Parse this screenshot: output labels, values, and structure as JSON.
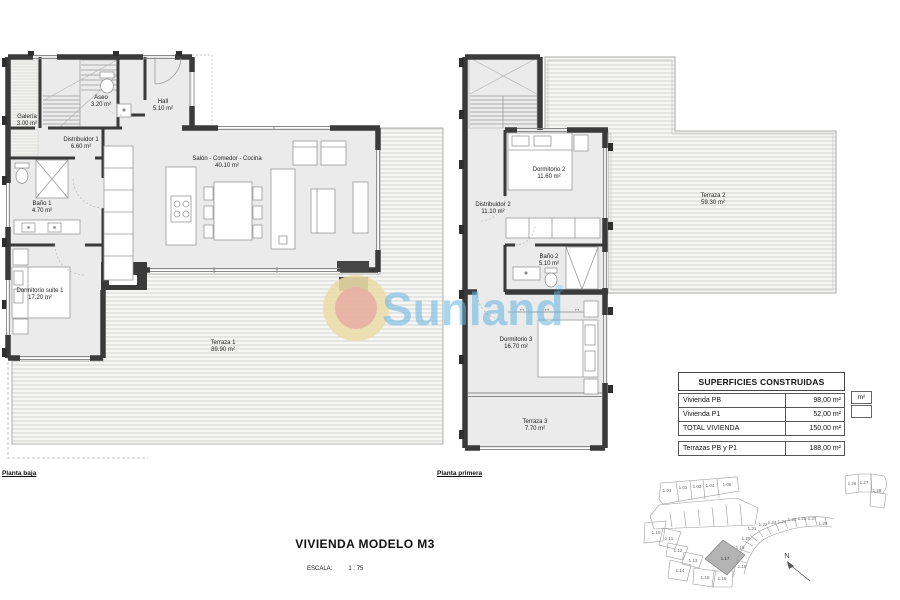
{
  "watermark": {
    "brand": "Sunland",
    "registered_mark": "®"
  },
  "floor_plans": {
    "left": {
      "caption": "Planta baja",
      "rooms": {
        "galeria": {
          "name": "Galería",
          "area": "3.00 m²"
        },
        "aseo": {
          "name": "Aseo",
          "area": "3.20 m²"
        },
        "hall": {
          "name": "Hall",
          "area": "5.10 m²"
        },
        "distribuidor1": {
          "name": "Distribuidor 1",
          "area": "6.60 m²"
        },
        "salon": {
          "name": "Salón - Comedor - Cocina",
          "area": "40.10 m²"
        },
        "bano1": {
          "name": "Baño 1",
          "area": "4.70 m²"
        },
        "dormitorio_suite1": {
          "name": "Dormitorio suite 1",
          "area": "17.20 m²"
        },
        "terraza1": {
          "name": "Terraza 1",
          "area": "89.90 m²"
        }
      }
    },
    "right": {
      "caption": "Planta primera",
      "rooms": {
        "dormitorio2": {
          "name": "Dormitorio 2",
          "area": "11.60 m²"
        },
        "distribuidor2": {
          "name": "Distribuidor 2",
          "area": "11.10 m²"
        },
        "bano2": {
          "name": "Baño 2",
          "area": "5.10 m²"
        },
        "dormitorio3": {
          "name": "Dormitorio 3",
          "area": "16.70 m²"
        },
        "terraza3": {
          "name": "Terraza 3",
          "area": "7.70 m²"
        },
        "terraza2": {
          "name": "Terraza 2",
          "area": "59.30 m²"
        }
      }
    }
  },
  "title_block": {
    "title": "VIVIENDA MODELO M3",
    "scale_label": "ESCALA:",
    "scale_value": "1 : 75"
  },
  "areas_table": {
    "header": "SUPERFICIES CONSTRUIDAS",
    "rows": [
      {
        "label": "Vivienda PB",
        "value": "98,00 m²"
      },
      {
        "label": "Vivienda P1",
        "value": "52,00 m²"
      },
      {
        "label": "TOTAL VIVIENDA",
        "value": "150,00 m²"
      }
    ],
    "terrace_row": {
      "label": "Terrazas PB y P1",
      "value": "188,00 m²"
    },
    "clipped_unit": "m²"
  },
  "site_plan": {
    "north_label": "N",
    "highlight_plot": "1.17",
    "row_top": [
      "1.01",
      "1.02",
      "1.03",
      "1.04",
      "1.05"
    ],
    "cluster": [
      "1.10",
      "1.11",
      "1.12",
      "1.13",
      "1.14",
      "1.15",
      "1.16"
    ],
    "arc": [
      "1.18",
      "1.19",
      "1.20",
      "1.21",
      "1.22",
      "1.23",
      "1.24",
      "1.25",
      "1.26",
      "1.27",
      "1.28"
    ],
    "edge": [
      "1.26",
      "1.27",
      "1.28"
    ]
  },
  "icons": {
    "sliding_arrow": "↔"
  },
  "colors": {
    "wall": "#3a3a3a",
    "floor": "#ebebeb",
    "hatch_line": "#cccccc",
    "watermark_blue": "#74b9e0",
    "sun_outer": "#eee0b0",
    "sun_inner": "#e9b6a9",
    "highlight_plot_fill": "#b4b4b4"
  }
}
